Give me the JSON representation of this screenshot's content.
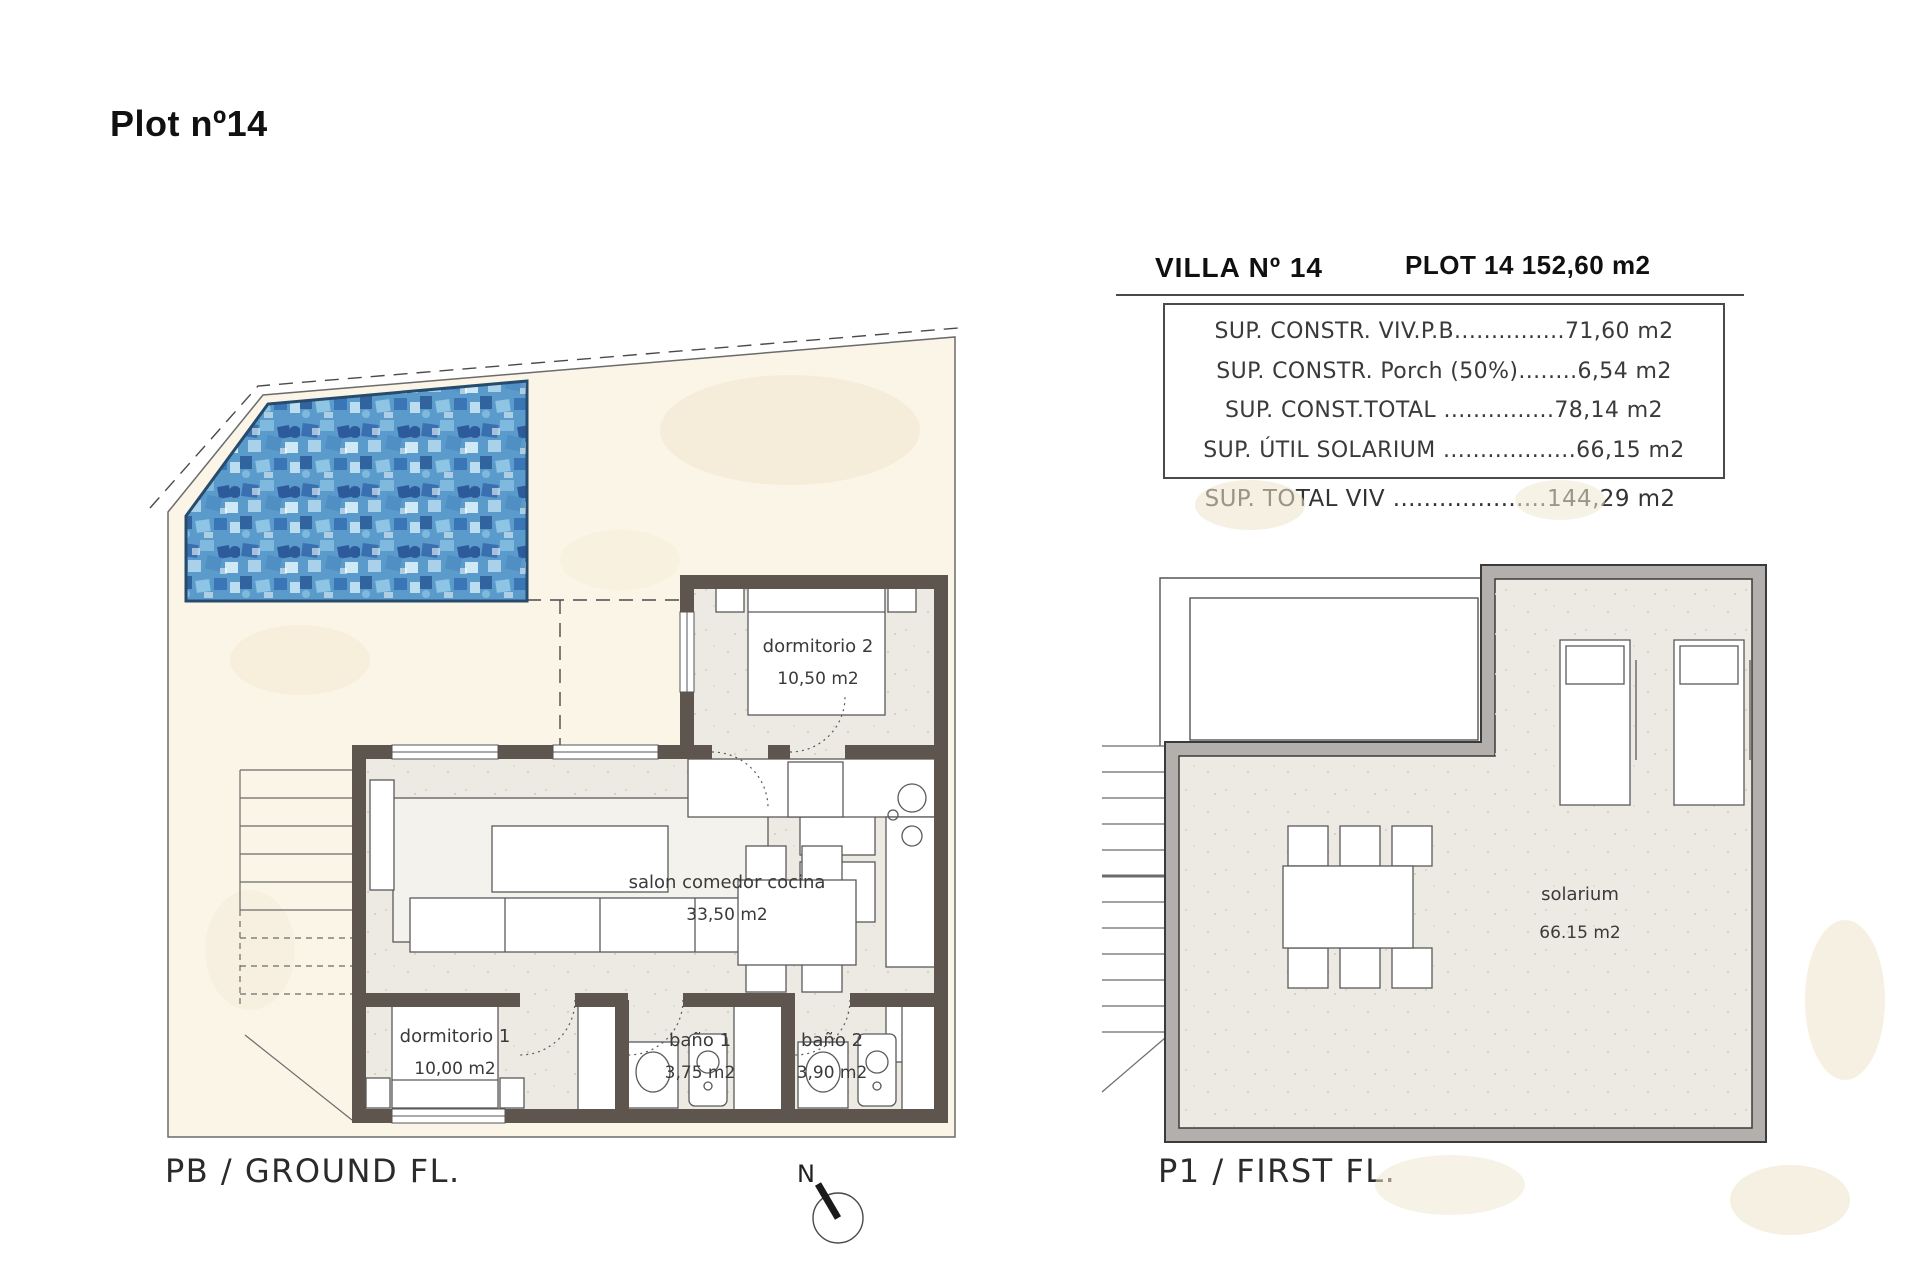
{
  "page": {
    "title": "Plot nº14"
  },
  "info_panel": {
    "villa_title": "VILLA Nº 14",
    "plot_title": "PLOT 14 152,60 m2",
    "rows": [
      "SUP. CONSTR. VIV.P.B...............71,60 m2",
      "SUP. CONSTR. Porch (50%)........6,54 m2",
      "SUP. CONST.TOTAL ...............78,14 m2",
      "SUP. ÚTIL SOLARIUM ..................66,15 m2"
    ],
    "total_row": "SUP. TOTAL VIV ....................144,29 m2"
  },
  "ground_floor": {
    "caption": "PB / GROUND FL.",
    "rooms": [
      {
        "name": "dormitorio 2",
        "area": "10,50 m2"
      },
      {
        "name": "salon comedor cocina",
        "area": "33,50 m2"
      },
      {
        "name": "dormitorio 1",
        "area": "10,00 m2"
      },
      {
        "name": "baño 1",
        "area": "3,75 m2"
      },
      {
        "name": "baño 2",
        "area": "3,90 m2"
      }
    ]
  },
  "first_floor": {
    "caption": "P1 / FIRST FL.",
    "rooms": [
      {
        "name": "solarium",
        "area": "66.15 m2"
      }
    ]
  },
  "compass": {
    "north_label": "N"
  },
  "colors": {
    "wall_ground_floor": "#5d554e",
    "wall_first_floor": "#b2afac",
    "plot_paper": "#fbf5e8",
    "interior_floor": "#edeae3",
    "pool_base": "#5b9bcb",
    "pool_dark": "#2f5f9e",
    "pool_light": "#bcdcef"
  }
}
